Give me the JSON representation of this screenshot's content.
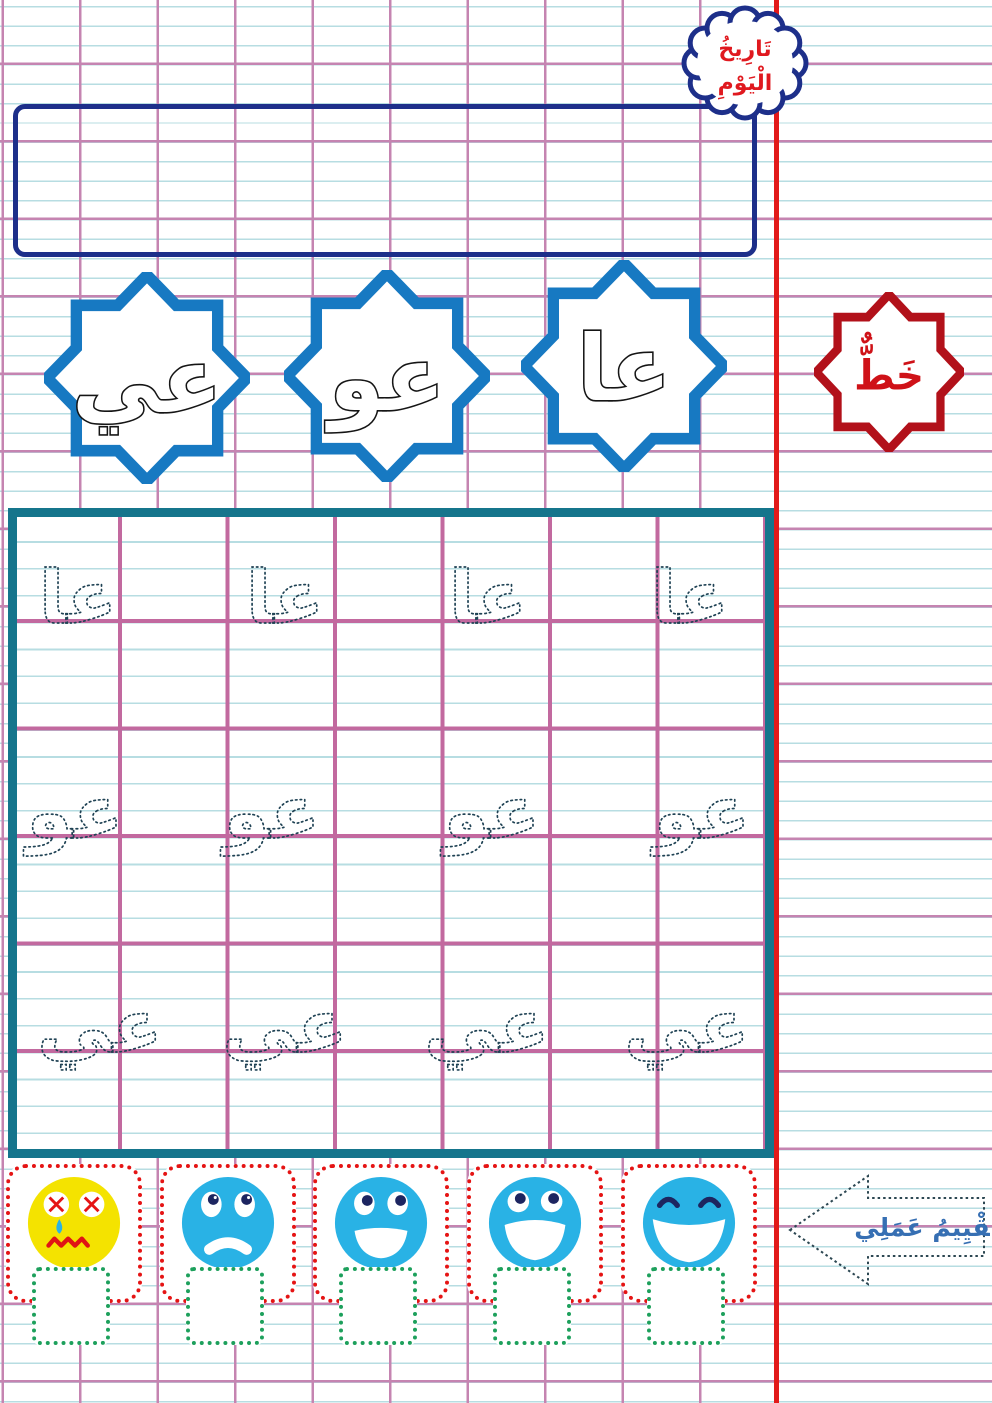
{
  "worksheet": {
    "date_cloud": {
      "line1": "تَارِيخُ",
      "line2": "الْيَوْمِ"
    },
    "subject_star_label": "خَطٌّ"
  },
  "letter_stars": [
    {
      "letters": "عي"
    },
    {
      "letters": "عو"
    },
    {
      "letters": "عا"
    }
  ],
  "practice_grid": {
    "rows": [
      {
        "trace_text": "عا",
        "repeat": 4
      },
      {
        "trace_text": "عو",
        "repeat": 4
      },
      {
        "trace_text": "عي",
        "repeat": 4
      }
    ]
  },
  "evaluation": {
    "arrow_label": "تَقْيِيمُ عَمَلِي",
    "faces": [
      {
        "mood": "very-sad",
        "color": "#f4e300"
      },
      {
        "mood": "sad",
        "color": "#29b2e5"
      },
      {
        "mood": "okay",
        "color": "#29b2e5"
      },
      {
        "mood": "happy",
        "color": "#29b2e5"
      },
      {
        "mood": "very-happy",
        "color": "#29b2e5"
      }
    ]
  },
  "colors": {
    "rule_blue": "#b7dde2",
    "rule_pink": "#c584b1",
    "margin_red": "#e21a1a",
    "star_blue": "#1779c2",
    "navy_border": "#1d2f8a",
    "dark_red_star": "#b2111a",
    "grid_teal": "#15758c",
    "trace_dots": "#1f4254",
    "eval_box_red": "#e51414",
    "check_green": "#1da05c",
    "eval_text_blue": "#366fb3"
  }
}
